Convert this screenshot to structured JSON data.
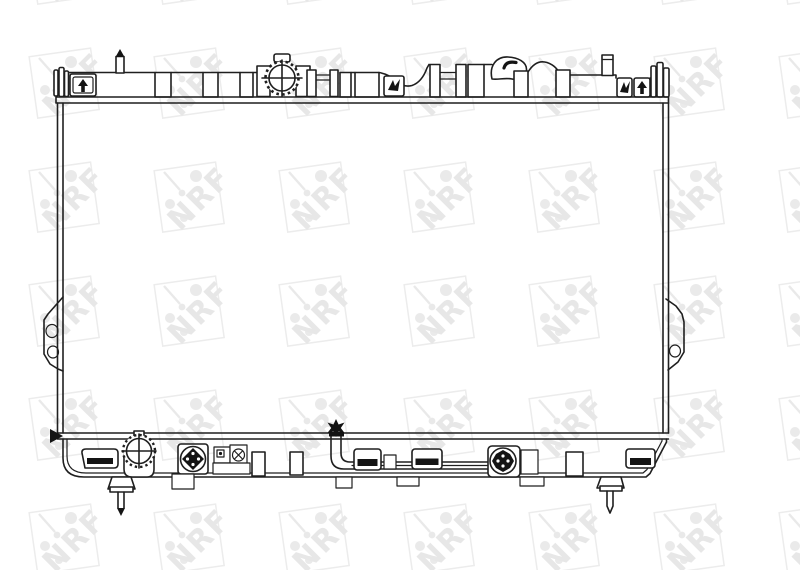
{
  "image": {
    "title": "Radiator technical line drawing",
    "width": 800,
    "height": 570,
    "background": "#ffffff"
  },
  "watermark": {
    "text": "NRF",
    "letter_color": "#e7e7e7",
    "shape_color": "#ececec",
    "dot_color": "#eaeaea"
  },
  "drawing": {
    "stroke_color": "#1f1f1f",
    "solid_color": "#141414",
    "components": [
      "top-tank",
      "filler-cap",
      "top-mounting-pin-left",
      "top-mounting-pin-right",
      "retaining-clip-left",
      "retaining-clips-right",
      "core",
      "side-bracket-left",
      "side-bracket-right",
      "bottom-tank",
      "drain-plug",
      "hose-fitting",
      "screw-fitting",
      "oil-cooler-pipe",
      "pipe-star-marker",
      "pipe-clamps",
      "pipe-end-fitting",
      "bottom-mounting-pin-left",
      "bottom-mounting-pin-right",
      "bottom-clip-left",
      "bottom-clip-right",
      "corner-arrow-marker"
    ]
  }
}
